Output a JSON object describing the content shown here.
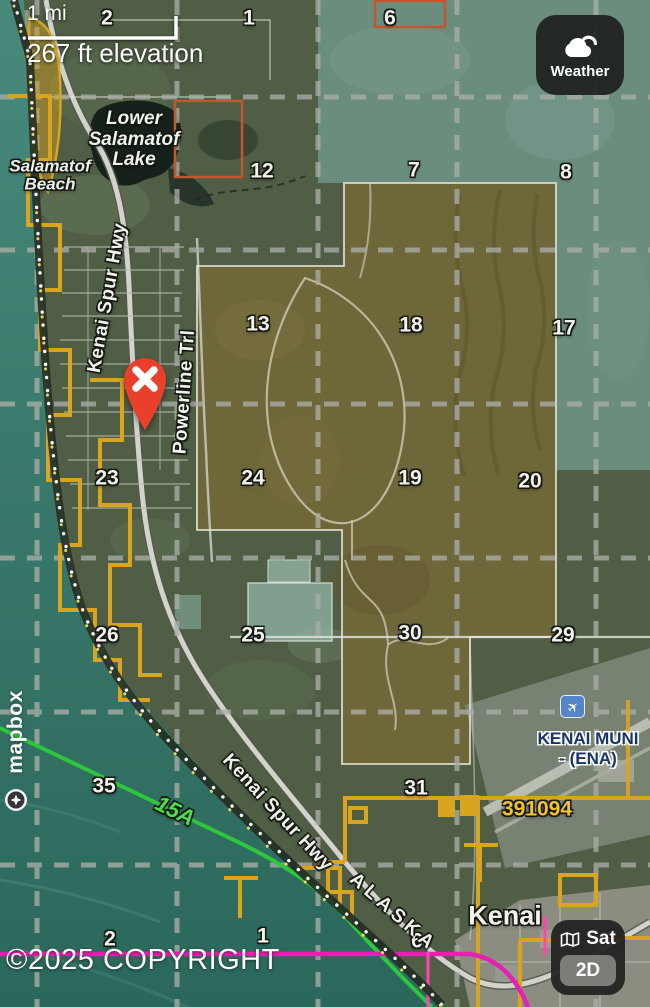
{
  "overlay": {
    "scale_label": "1 mi",
    "elevation_label": "267 ft elevation",
    "copyright": "©2025 COPYRIGHT",
    "brand": "mapbox"
  },
  "buttons": {
    "weather_label": "Weather",
    "sat_label": "Sat",
    "mode_2d_label": "2D"
  },
  "icons": {
    "weather": "cloud-with-sun",
    "layers": "folded-map",
    "airport": "airplane",
    "airplane_glyph": "✈",
    "marker": "red-pin-with-x",
    "brand": "mapbox-star-circle"
  },
  "places": {
    "lake": "Lower Salamatof Lake",
    "beach": "Salamatof Beach",
    "highway_upper": "Kenai Spur Hwy",
    "highway_lower": "Kenai Spur Hwy",
    "trail": "Powerline Trl",
    "state_boundary": "ALASKA",
    "route_15a": "15A",
    "airport_line1": "KENAI MUNI",
    "airport_line2": "- (ENA)",
    "parcel_number": "391094",
    "city": "Kenai"
  },
  "section_numbers": [
    "2",
    "1",
    "6",
    "12",
    "7",
    "8",
    "13",
    "18",
    "17",
    "23",
    "24",
    "19",
    "20",
    "26",
    "25",
    "30",
    "29",
    "35",
    "31",
    "2",
    "1",
    "6"
  ],
  "colors": {
    "parcel_orange": "#d9a41e",
    "survey_red_orange": "#c2562c",
    "route_green": "#2ec73c",
    "boundary_magenta": "#e620b2",
    "pin_red": "#e8402a",
    "airport_blue": "#5585c8",
    "water_teal": "#3c7c6f"
  }
}
